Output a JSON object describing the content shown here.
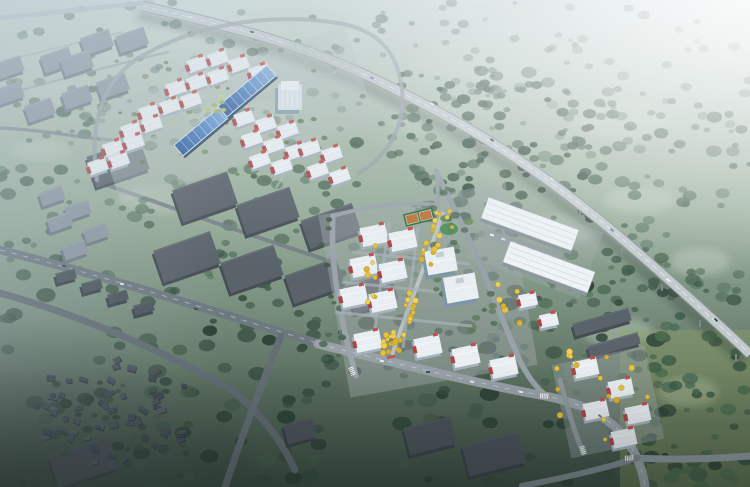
{
  "scene_type": "aerial-masterplan-rendering",
  "canvas": {
    "width": 750,
    "height": 487
  },
  "palette": {
    "bg_stops": [
      [
        0,
        "#cfdcd8"
      ],
      [
        0.25,
        "#adbfae"
      ],
      [
        0.45,
        "#95ab97"
      ],
      [
        0.62,
        "#7b9180"
      ],
      [
        0.8,
        "#586c5d"
      ],
      [
        1,
        "#3b4e43"
      ]
    ],
    "field_patch": "#c5d3c3",
    "br_field_tint": "#8ea266",
    "slab_mid": {
      "top": "#5a626a",
      "side": "#454d55",
      "hi": "#747c84"
    },
    "slab_dark": {
      "top": "#4b535b",
      "side": "#3a424a",
      "hi": "#5d656d"
    },
    "slab_light": {
      "top": "#8b96a0",
      "side": "#6d7882",
      "hi": "#a5b0ba"
    },
    "bld": {
      "top": "#e9eef2",
      "ridge": "#f8fbfc",
      "side": "#a6b2bb",
      "red": "#ac4644",
      "red2": "#c0504d"
    },
    "off": {
      "side": "#7e97a6",
      "face": "#9db2bf",
      "top": "#e8eef1"
    },
    "nw_office": {
      "side": "#8aa0af",
      "top": "#d8e2e8",
      "cap": "#eef3f6"
    },
    "shed": {
      "side": "#2c4a6b",
      "border": "#dfe8ee",
      "grad": [
        [
          "0",
          "#2d5c9c"
        ],
        [
          "0.5",
          "#4f82c4"
        ],
        [
          "1",
          "#83aede"
        ]
      ]
    },
    "wh": {
      "top": "#eef3f5",
      "rib": "#ccd4d8",
      "side": "#8d979e",
      "outline": "#b9c2c7"
    },
    "court": {
      "base": "#357247",
      "inner": "#bc763f",
      "line": "#e8f0e8"
    },
    "yellow": [
      "#e7c33d",
      "#f0d14f",
      "#d9b22f"
    ],
    "yellow_stroke": "#a8851f",
    "car_colors": [
      "#eef2f4",
      "#39424a",
      "#dce2e6",
      "#6f7a81"
    ],
    "village_cols": [
      "#4a535d",
      "#3f4852",
      "#565f69",
      "#444d57"
    ],
    "pad_nw": "#b7c1bf",
    "pad_lit": "#a2abae",
    "highway": {
      "shadow": "rgba(30,44,36,0.33)",
      "edge": "#8a9599",
      "deck": "#c2cacd",
      "line": "#ffffff",
      "pier": "#7d888d"
    }
  },
  "overlays": {
    "glare": [
      [
        0,
        "#ffffff",
        0.95
      ],
      [
        0.35,
        "#ffffff",
        0.55
      ],
      [
        0.6,
        "#ffffff",
        0.25
      ],
      [
        0.8,
        "#ffffff",
        0
      ]
    ],
    "top_haze": [
      [
        0,
        "#cdd9e0",
        0.5
      ],
      [
        0.3,
        "#cdd9e0",
        0.2
      ],
      [
        0.55,
        "#cdd9e0",
        0
      ]
    ],
    "left_haze": [
      [
        0,
        "#aebfca",
        0.3
      ],
      [
        0.3,
        "#aebfca",
        0
      ]
    ],
    "bl_vignette": [
      [
        0,
        "#121a18",
        0.42
      ],
      [
        0.6,
        "#121a18",
        0
      ]
    ],
    "bottom_shade": [
      [
        0,
        "#101816",
        0.3
      ],
      [
        0.25,
        "#101816",
        0
      ]
    ]
  },
  "field_patches": [
    [
      120,
      40,
      90,
      26
    ],
    [
      300,
      25,
      120,
      30
    ],
    [
      480,
      60,
      140,
      40
    ],
    [
      620,
      120,
      90,
      40
    ],
    [
      240,
      118,
      110,
      34
    ],
    [
      520,
      10,
      100,
      25
    ],
    [
      660,
      40,
      80,
      30
    ],
    [
      60,
      90,
      70,
      24
    ],
    [
      430,
      120,
      80,
      30
    ],
    [
      560,
      230,
      80,
      30
    ],
    [
      640,
      200,
      70,
      26
    ],
    [
      700,
      262,
      60,
      28
    ],
    [
      618,
      332,
      70,
      30
    ],
    [
      688,
      392,
      60,
      30
    ],
    [
      160,
      200,
      80,
      26
    ],
    [
      40,
      150,
      60,
      20
    ]
  ],
  "br_field": {
    "x": 620,
    "y": 330,
    "w": 130,
    "h": 157,
    "o": 0.4
  },
  "scatters": [
    {
      "name": "far-trees",
      "x": 0,
      "y": 0,
      "w": 750,
      "h": 148,
      "n": 160,
      "rmin": 2.5,
      "rmax": 6.5,
      "cols": [
        "#587663",
        "#4d6a58",
        "#647f6c"
      ],
      "omin": 0.4,
      "omax": 0.75,
      "seed": 101
    },
    {
      "name": "mid-right-trees",
      "x": 380,
      "y": 70,
      "w": 370,
      "h": 230,
      "n": 150,
      "rmin": 3,
      "rmax": 8,
      "cols": [
        "#3f5c4a",
        "#4b6854",
        "#577460"
      ],
      "omin": 0.55,
      "omax": 0.9,
      "seed": 102
    },
    {
      "name": "mid-left-trees",
      "x": 0,
      "y": 88,
      "w": 368,
      "h": 196,
      "n": 110,
      "rmin": 3,
      "rmax": 8,
      "cols": [
        "#3f5c4a",
        "#4b6854",
        "#577460"
      ],
      "omin": 0.5,
      "omax": 0.85,
      "seed": 103
    },
    {
      "name": "highway-forest",
      "x": 424,
      "y": 84,
      "w": 168,
      "h": 140,
      "n": 70,
      "rmin": 3,
      "rmax": 7,
      "cols": [
        "#2e4939",
        "#3a5645",
        "#466250"
      ],
      "omin": 0.75,
      "omax": 0.95,
      "seed": 104
    },
    {
      "name": "se-green-band",
      "x": 492,
      "y": 252,
      "w": 210,
      "h": 140,
      "n": 55,
      "rmin": 3,
      "rmax": 8,
      "cols": [
        "#42604a",
        "#4f6d55"
      ],
      "omin": 0.6,
      "omax": 0.9,
      "seed": 105
    },
    {
      "name": "foreground-trees",
      "x": 0,
      "y": 282,
      "w": 750,
      "h": 205,
      "n": 170,
      "rmin": 3.5,
      "rmax": 10,
      "cols": [
        "#2c4136",
        "#374e41",
        "#445c4b"
      ],
      "omin": 0.7,
      "omax": 0.97,
      "seed": 106
    },
    {
      "name": "br-field-trees",
      "x": 628,
      "y": 336,
      "w": 122,
      "h": 151,
      "n": 40,
      "rmin": 3,
      "rmax": 8,
      "cols": [
        "#3d5a44",
        "#4a6a4f"
      ],
      "omin": 0.75,
      "omax": 0.95,
      "seed": 107
    }
  ],
  "village": {
    "cx": 113,
    "cy": 412,
    "rx": 82,
    "ry": 54,
    "count": 64,
    "seed": 11
  },
  "village_trees": {
    "x": 45,
    "y": 365,
    "w": 150,
    "h": 95,
    "n": 22,
    "rmin": 2.5,
    "rmax": 6,
    "cols": [
      "#30473a",
      "#3b523f"
    ],
    "omin": 0.7,
    "omax": 0.95,
    "seed": 108
  },
  "context_roads": [
    {
      "d": "M 0,18 L 152,2",
      "w": 5,
      "c": "#b7c1c7",
      "o": 0.9,
      "dash": false
    },
    {
      "d": "M 0,96 C 50,82 110,66 168,52",
      "w": 2.2,
      "c": "#8c969e",
      "o": 0.6,
      "dash": false
    },
    {
      "d": "M 0,62 C 40,52 80,42 122,32",
      "w": 1.8,
      "c": "#98a2a8",
      "o": 0.5,
      "dash": false
    },
    {
      "d": "M 0,128 C 45,130 80,138 112,140",
      "w": 3.2,
      "c": "#7b858c",
      "o": 0.85,
      "dash": false
    },
    {
      "d": "M 0,250 C 112,278 222,314 330,347",
      "w": 8.5,
      "c": "#6e7880",
      "o": 1,
      "dash": true
    },
    {
      "d": "M 0,293 C 82,316 162,350 232,390 C 260,412 281,440 295,470",
      "w": 7,
      "c": "#606a72",
      "o": 1,
      "dash": false
    },
    {
      "d": "M 281,336 C 263,382 243,432 225,487",
      "w": 7,
      "c": "#646e76",
      "o": 1,
      "dash": false
    },
    {
      "d": "M 93,180 C 172,208 252,236 333,262",
      "w": 4,
      "c": "#727c84",
      "o": 0.85,
      "dash": false
    }
  ],
  "lit_roads": [
    {
      "d": "M 318,344 C 392,362 470,382 545,396 C 602,407 624,430 637,458 C 642,470 644,478 645,487",
      "w": 9,
      "c": "#97a1a7",
      "o": 1,
      "dash": true
    },
    {
      "d": "M 637,458 C 672,460 712,459 750,456",
      "w": 7,
      "c": "#8d979d",
      "o": 1,
      "dash": false
    },
    {
      "d": "M 637,458 C 600,470 562,478 522,486",
      "w": 6,
      "c": "#7f898f",
      "o": 1,
      "dash": false
    },
    {
      "d": "M 333,216 C 330,262 339,316 356,376",
      "w": 5.5,
      "c": "#9aa4aa",
      "o": 1,
      "dash": false
    },
    {
      "d": "M 436,171 C 456,213 472,243 486,278 C 497,306 508,333 520,361 C 528,377 537,389 547,396",
      "w": 5.5,
      "c": "#98a2a8",
      "o": 1,
      "dash": false
    },
    {
      "d": "M 333,216 C 370,205 404,201 438,205",
      "w": 4,
      "c": "#9aa4aa",
      "o": 1,
      "dash": false
    },
    {
      "d": "M 438,205 L 437,171",
      "w": 4,
      "c": "#9aa4aa",
      "o": 1,
      "dash": false
    },
    {
      "d": "M 560,380 C 567,406 574,431 583,453",
      "w": 5,
      "c": "#8f999f",
      "o": 1,
      "dash": false
    },
    {
      "d": "M 97,180 C 89,127 101,83 137,59 C 197,22 277,12 343,24 C 381,32 398,55 402,89 C 405,123 392,153 359,173",
      "w": 4,
      "c": "#9aa3a9",
      "o": 0.85,
      "dash": false
    }
  ],
  "spine_road": {
    "d": "M 443,212 C 432,245 420,278 408,310 C 402,326 397,340 392,355",
    "w": 4,
    "c": "#c6cccf",
    "o": 0.8
  },
  "nw_streets": [
    "M 120,150 L 336,72",
    "M 146,122 L 282,74",
    "M 196,52 L 118,163",
    "M 258,64 L 199,172",
    "M 318,118 L 276,188"
  ],
  "central_streets": [
    "M 389,222 L 373,344",
    "M 418,227 L 403,348",
    "M 352,252 L 470,264",
    "M 342,282 L 460,294",
    "M 335,312 L 472,326"
  ],
  "crosswalks": [
    {
      "x": 352,
      "y": 371,
      "a": 68
    },
    {
      "x": 544,
      "y": 396,
      "a": 5
    },
    {
      "x": 629,
      "y": 458,
      "a": -5
    },
    {
      "x": 583,
      "y": 450,
      "a": 72
    }
  ],
  "slabs": [
    [
      118,
      163,
      56,
      32,
      -19,
      "mid"
    ],
    [
      205,
      197,
      58,
      34,
      -19,
      "mid"
    ],
    [
      268,
      211,
      56,
      32,
      -19,
      "mid"
    ],
    [
      331,
      226,
      54,
      30,
      -19,
      "mid"
    ],
    [
      187,
      257,
      60,
      34,
      -19,
      "mid"
    ],
    [
      252,
      269,
      56,
      32,
      -19,
      "mid"
    ],
    [
      315,
      281,
      54,
      30,
      -19,
      "mid"
    ],
    [
      372,
      293,
      46,
      28,
      -19,
      "mid"
    ],
    [
      83,
      462,
      62,
      34,
      -18,
      "dark"
    ],
    [
      430,
      436,
      48,
      28,
      -14,
      "dark"
    ],
    [
      494,
      454,
      58,
      32,
      -14,
      "dark"
    ],
    [
      300,
      431,
      30,
      20,
      -15,
      "dark"
    ],
    [
      66,
      276,
      20,
      10,
      -15,
      "dark"
    ],
    [
      92,
      286,
      20,
      10,
      -15,
      "dark"
    ],
    [
      118,
      297,
      20,
      10,
      -15,
      "dark"
    ],
    [
      144,
      308,
      20,
      10,
      -15,
      "dark"
    ],
    [
      602,
      322,
      58,
      13,
      -16,
      "mid"
    ],
    [
      614,
      345,
      52,
      12,
      -16,
      "mid"
    ]
  ],
  "light_boxes": [
    [
      97,
      42,
      30,
      18
    ],
    [
      132,
      40,
      30,
      18
    ],
    [
      57,
      60,
      30,
      18
    ],
    [
      77,
      63,
      30,
      18
    ],
    [
      10,
      67,
      26,
      16
    ],
    [
      40,
      110,
      28,
      17
    ],
    [
      113,
      86,
      30,
      18
    ],
    [
      77,
      97,
      28,
      17
    ],
    [
      10,
      93,
      26,
      16
    ],
    [
      52,
      196,
      24,
      14
    ],
    [
      78,
      210,
      24,
      14
    ],
    [
      60,
      222,
      24,
      14
    ],
    [
      96,
      233,
      24,
      14
    ],
    [
      75,
      250,
      24,
      14
    ]
  ],
  "nw_campus": {
    "pad": {
      "x": 233,
      "y": 115,
      "w": 268,
      "h": 100,
      "a": -18,
      "o": 0.42
    },
    "buildings": [
      [
        197,
        64
      ],
      [
        218,
        58
      ],
      [
        239,
        64
      ],
      [
        259,
        72
      ],
      [
        176,
        88
      ],
      [
        197,
        82
      ],
      [
        218,
        76
      ],
      [
        149,
        112
      ],
      [
        170,
        106
      ],
      [
        191,
        100
      ],
      [
        131,
        130
      ],
      [
        152,
        124
      ],
      [
        113,
        148
      ],
      [
        134,
        142
      ],
      [
        98,
        166
      ],
      [
        119,
        160
      ],
      [
        244,
        118
      ],
      [
        266,
        124
      ],
      [
        288,
        130
      ],
      [
        252,
        139
      ],
      [
        274,
        145
      ],
      [
        296,
        151
      ],
      [
        260,
        160
      ],
      [
        282,
        166
      ],
      [
        310,
        148
      ],
      [
        332,
        154
      ],
      [
        318,
        170
      ],
      [
        340,
        176
      ]
    ],
    "bld_w": 19,
    "bld_h": 13,
    "bld_a": -19,
    "sheds": [
      {
        "x": 203,
        "y": 130,
        "l": 64,
        "wd": 14,
        "a": -40
      },
      {
        "x": 247,
        "y": 91,
        "l": 64,
        "wd": 14,
        "a": -40
      }
    ],
    "office": {
      "x": 290,
      "y": 97,
      "w": 24,
      "h": 26
    },
    "hedges": {
      "x": 100,
      "y": 50,
      "w": 260,
      "h": 130,
      "n": 26,
      "rmin": 1.8,
      "rmax": 3.5,
      "cols": [
        "#5c7a55",
        "#6b8a60"
      ],
      "omin": 0.7,
      "omax": 0.95,
      "seed": 113
    },
    "center_trees": {
      "x": 205,
      "y": 94,
      "w": 22,
      "h": 18,
      "n": 6,
      "rmin": 2,
      "rmax": 3.5,
      "cols": [
        "#b9c06b",
        "#c8cf7a",
        "#a7b15c"
      ],
      "omin": 0.85,
      "omax": 1,
      "seed": 125
    }
  },
  "mid_zone": {
    "pad": {
      "x": 535,
      "y": 245,
      "w": 120,
      "h": 70,
      "a": 20,
      "o": 0.35
    },
    "warehouses": [
      {
        "x": 530,
        "y": 224,
        "l": 96,
        "wd": 22,
        "a": 20
      },
      {
        "x": 549,
        "y": 267,
        "l": 90,
        "wd": 22,
        "a": 20
      }
    ],
    "parking": {
      "x": 522,
      "y": 246,
      "l": 80,
      "wd": 10,
      "a": 20
    },
    "extra_buildings": [
      [
        528,
        300
      ],
      [
        549,
        320
      ]
    ]
  },
  "central_campus": {
    "pad": {
      "x": 428,
      "y": 290,
      "w": 190,
      "h": 185,
      "a": -10,
      "o": 0.45
    },
    "buildings": [
      [
        374,
        235
      ],
      [
        403,
        240
      ],
      [
        364,
        266
      ],
      [
        393,
        271
      ],
      [
        354,
        296
      ],
      [
        383,
        301
      ],
      [
        368,
        341
      ],
      [
        428,
        346
      ],
      [
        466,
        356
      ],
      [
        504,
        367
      ]
    ],
    "bld_w": 26,
    "bld_h": 19,
    "bld_a": -12,
    "offices": [
      {
        "x": 441,
        "y": 261,
        "w": 30,
        "h": 24
      },
      {
        "x": 461,
        "y": 288,
        "w": 32,
        "h": 26
      }
    ],
    "court": {
      "x": 419,
      "y": 217,
      "w": 30,
      "h": 13,
      "a": -14
    },
    "green_patch": {
      "x": 449,
      "y": 229,
      "rx": 9,
      "ry": 6
    },
    "gate": {
      "x": 391,
      "y": 357,
      "a": -14
    },
    "spine_yellows": {
      "count": 30,
      "seed": 5,
      "offsets": [
        -4.5,
        4.5
      ]
    },
    "greens": [
      {
        "x": 318,
        "y": 215,
        "w": 26,
        "h": 150,
        "n": 13,
        "rmin": 2.5,
        "rmax": 5,
        "cols": [
          "#3d5948",
          "#4a6651"
        ],
        "omin": 0.7,
        "omax": 0.9,
        "seed": 109
      },
      {
        "x": 432,
        "y": 178,
        "w": 26,
        "h": 118,
        "n": 15,
        "rmin": 2.5,
        "rmax": 5,
        "cols": [
          "#4f6b50",
          "#5d7b58"
        ],
        "omin": 0.7,
        "omax": 0.9,
        "seed": 110
      },
      {
        "x": 468,
        "y": 288,
        "w": 34,
        "h": 86,
        "n": 12,
        "rmin": 2.5,
        "rmax": 5,
        "cols": [
          "#4f6b50",
          "#5d7b58"
        ],
        "omin": 0.7,
        "omax": 0.9,
        "seed": 111
      },
      {
        "x": 440,
        "y": 210,
        "w": 40,
        "h": 30,
        "n": 6,
        "rmin": 2.5,
        "rmax": 5,
        "cols": [
          "#4f6b50",
          "#6d8c62"
        ],
        "omin": 0.7,
        "omax": 0.9,
        "seed": 112
      }
    ]
  },
  "se_campus": {
    "buildings": [
      [
        586,
        368
      ],
      [
        621,
        388
      ],
      [
        596,
        410
      ],
      [
        638,
        414
      ],
      [
        624,
        438
      ]
    ],
    "bld_w": 24,
    "bld_h": 17,
    "bld_a": -12
  },
  "yellow_regions": [
    {
      "x": 366,
      "y": 245,
      "w": 10,
      "h": 60,
      "n": 8,
      "seed": 120
    },
    {
      "x": 382,
      "y": 330,
      "w": 28,
      "h": 24,
      "n": 9,
      "seed": 121
    },
    {
      "x": 556,
      "y": 348,
      "w": 92,
      "h": 96,
      "n": 16,
      "seed": 122
    },
    {
      "x": 492,
      "y": 284,
      "w": 32,
      "h": 42,
      "n": 6,
      "seed": 123
    },
    {
      "x": 430,
      "y": 205,
      "w": 26,
      "h": 24,
      "n": 5,
      "seed": 124
    }
  ],
  "highway": {
    "d": "M 142,6 C 230,26 300,44 368,76 C 470,125 540,168 628,244 C 672,282 710,316 750,354",
    "piers": [
      [
        580,
        204
      ],
      [
        622,
        242
      ],
      [
        662,
        279
      ],
      [
        700,
        315
      ],
      [
        736,
        349
      ]
    ],
    "cars": [
      [
        190,
        17,
        12
      ],
      [
        252,
        32,
        16
      ],
      [
        312,
        49,
        22
      ],
      [
        372,
        78,
        27
      ],
      [
        432,
        104,
        30
      ],
      [
        492,
        140,
        33
      ],
      [
        552,
        179,
        37
      ],
      [
        612,
        230,
        41
      ],
      [
        668,
        280,
        43
      ],
      [
        716,
        320,
        45
      ]
    ]
  },
  "road_cars": [
    {
      "x": 382,
      "y": 361,
      "a": 8,
      "ci": 0
    },
    {
      "x": 428,
      "y": 372,
      "a": 9,
      "ci": 1
    },
    {
      "x": 472,
      "y": 382,
      "a": 9,
      "ci": 2
    },
    {
      "x": 521,
      "y": 392,
      "a": 7,
      "ci": 0
    },
    {
      "x": 600,
      "y": 416,
      "a": 35,
      "ci": 3
    },
    {
      "x": 64,
      "y": 266,
      "a": 14,
      "ci": 1
    },
    {
      "x": 122,
      "y": 284,
      "a": 16,
      "ci": 0
    },
    {
      "x": 196,
      "y": 309,
      "a": 17,
      "ci": 1
    },
    {
      "x": 255,
      "y": 330,
      "a": 17,
      "ci": 3
    }
  ]
}
